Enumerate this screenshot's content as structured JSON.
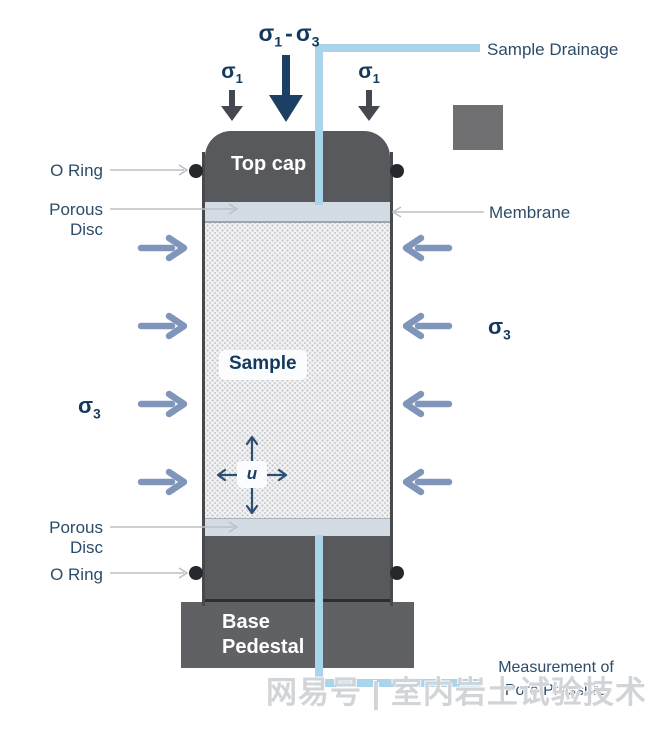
{
  "diagram_title": "Triaxial test cell schematic",
  "labels": {
    "deviator": {
      "sigma_a": "σ",
      "sub_a": "1",
      "minus": "-",
      "sigma_b": "σ",
      "sub_b": "3"
    },
    "axial": {
      "sigma": "σ",
      "sub": "1"
    },
    "confining": {
      "sigma": "σ",
      "sub": "3"
    },
    "sample_drainage": "Sample Drainage",
    "o_ring": "O Ring",
    "porous_disc": "Porous Disc",
    "membrane": "Membrane",
    "top_cap": "Top cap",
    "sample": "Sample",
    "pore_pressure_symbol": "u",
    "base_line1": "Base",
    "base_line2": "Pedestal",
    "measurement_line1": "Measurement of",
    "measurement_line2": "Pore Pressure",
    "watermark": "网易号 | 室内岩土试验技术分享"
  },
  "colors": {
    "navy_text": "#14395e",
    "label_text": "#2c4c6a",
    "cap_gray": "#58595d",
    "base_gray": "#606165",
    "porous_disc": "#d3dce5",
    "confining_arrow_blue": "#8095ba",
    "axial_arrow_gray": "#45494f",
    "deviator_arrow_navy": "#1b4063",
    "drainage_tube_blue": "#a9d4ea",
    "thin_arrow_gray": "#bcc0c5",
    "o_ring_black": "#25282c"
  }
}
